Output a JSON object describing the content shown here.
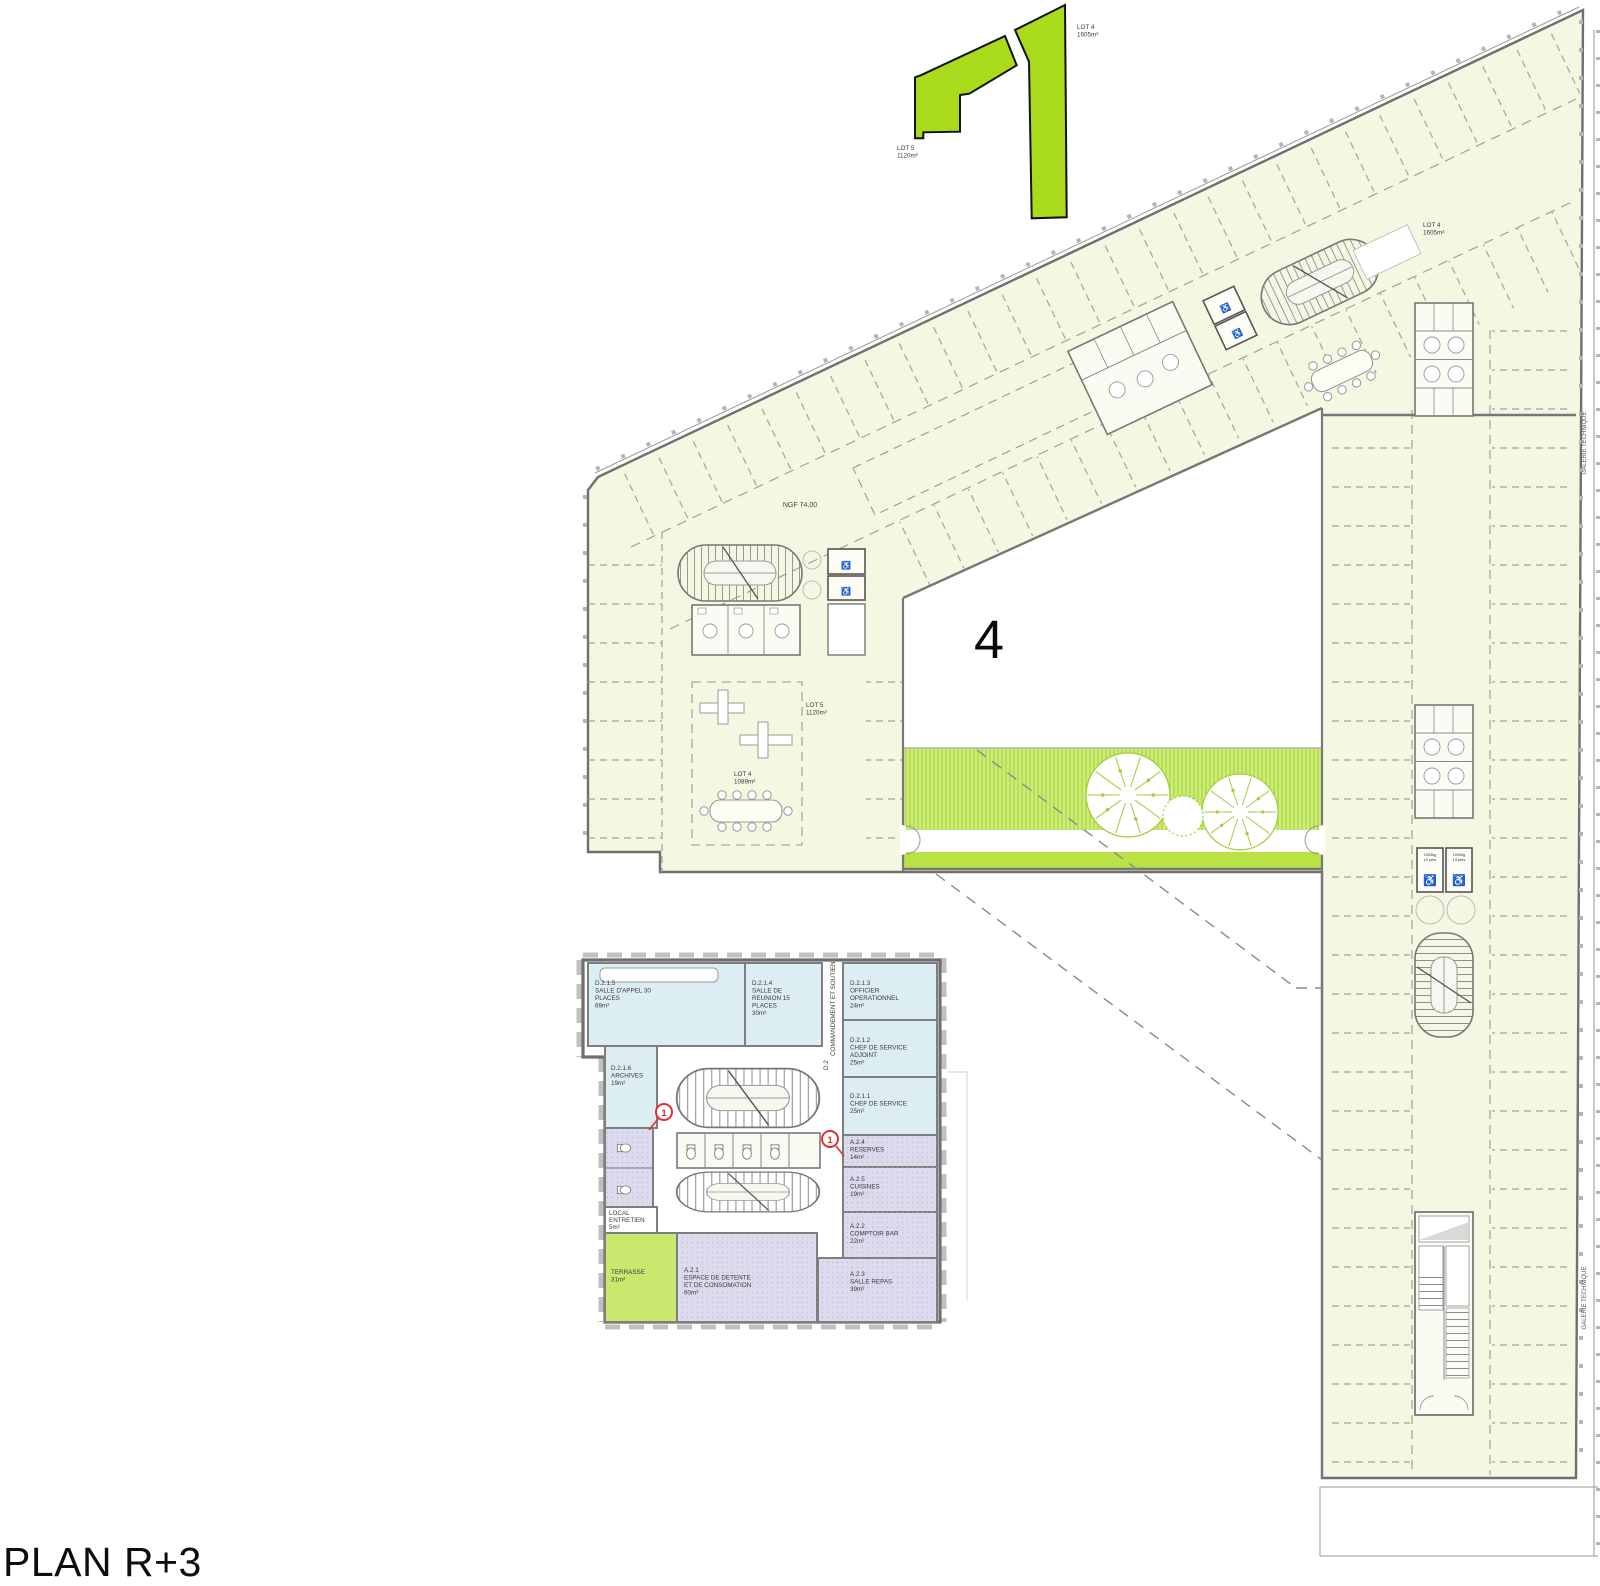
{
  "page": {
    "title": "PLAN R+3"
  },
  "colors": {
    "floor": "#f4f8e3",
    "keyplan_lime": "#a9da1c",
    "strip_light": "#cdec80",
    "strip_dark": "#b9e245",
    "room_blue": "#dcedf4",
    "room_purple": "#dcdbee",
    "terrace_green": "#c9e96e",
    "wall_gray": "#6f6f6f",
    "marker_red": "#e03030"
  },
  "icons": {
    "wheelchair": "♿"
  },
  "key_plan": {
    "lot5": {
      "name": "LOT 5",
      "area": "1120m²"
    },
    "lot4": {
      "name": "LOT 4",
      "area": "1605m²"
    }
  },
  "main_plan": {
    "ngf": "NGF 74.00",
    "building_number": "4",
    "galerie": "GALERIE TECHNIQUE",
    "lot4_wing": {
      "name": "LOT 4",
      "area": "1605m²"
    },
    "lot5_zone": {
      "name": "LOT 5",
      "area": "1120m²"
    },
    "lot4_zone": {
      "name": "LOT 4",
      "area": "1089m²"
    },
    "elevator": {
      "l1": "1000kg",
      "l2": "13 pers"
    }
  },
  "detail_plan": {
    "corridor": {
      "code": "D.2",
      "name": "COMMANDEMENT ET SOUTIEN"
    },
    "markers": {
      "m1": "1",
      "m2": "1"
    },
    "rooms": {
      "d215": {
        "code": "D.2.1.5",
        "lines": [
          "SALLE D'APPEL 30",
          "PLACES"
        ],
        "area": "69m²"
      },
      "d214": {
        "code": "D.2.1.4",
        "lines": [
          "SALLE DE",
          "REUNION 15",
          "PLACES"
        ],
        "area": "30m²"
      },
      "d213": {
        "code": "D.2.1.3",
        "lines": [
          "OFFICIER",
          "OPERATIONNEL"
        ],
        "area": "24m²"
      },
      "d212": {
        "code": "D.2.1.2",
        "lines": [
          "CHEF DE SERVICE",
          "ADJOINT"
        ],
        "area": "25m²"
      },
      "d211": {
        "code": "D.2.1.1",
        "lines": [
          "CHEF DE SERVICE"
        ],
        "area": "25m²"
      },
      "d216": {
        "code": "D.2.1.6",
        "lines": [
          "ARCHIVES"
        ],
        "area": "19m²"
      },
      "a24": {
        "code": "A.2.4",
        "lines": [
          "RESERVES"
        ],
        "area": "14m²"
      },
      "a25": {
        "code": "A.2.5",
        "lines": [
          "CUISINES"
        ],
        "area": "19m²"
      },
      "a22": {
        "code": "A.2.2",
        "lines": [
          "COMPTOIR BAR"
        ],
        "area": "22m²"
      },
      "a23": {
        "code": "A.2.3",
        "lines": [
          "SALLE REPAS"
        ],
        "area": "39m²"
      },
      "a21": {
        "code": "A.2.1",
        "lines": [
          "ESPACE DE DETENTE",
          "ET DE CONSOMATION"
        ],
        "area": "60m²"
      },
      "local": {
        "code": "",
        "lines": [
          "LOCAL",
          "ENTRETIEN"
        ],
        "area": "5m²"
      },
      "terrasse": {
        "code": "",
        "lines": [
          "TERRASSE"
        ],
        "area": "31m²"
      }
    }
  }
}
